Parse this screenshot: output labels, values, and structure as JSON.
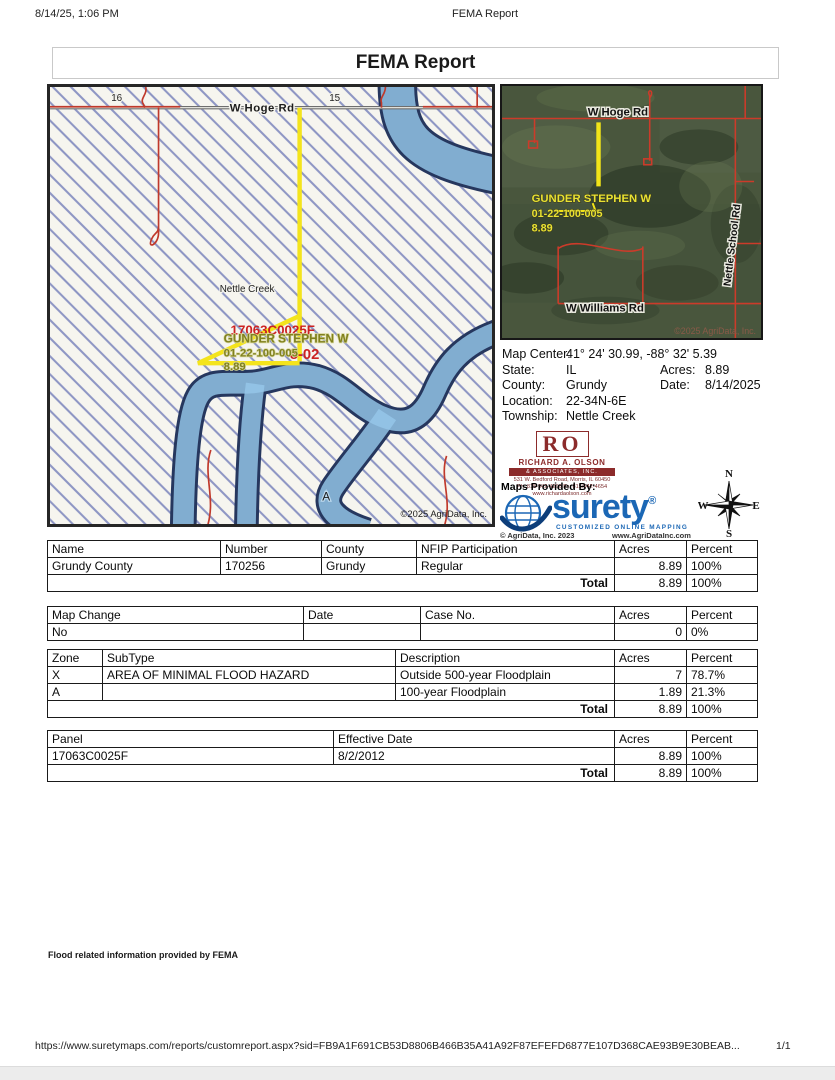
{
  "page": {
    "print_datetime": "8/14/25, 1:06 PM",
    "print_title": "FEMA Report",
    "title": "FEMA Report",
    "footer_note": "Flood related information provided by FEMA",
    "footer_url": "https://www.suretymaps.com/reports/customreport.aspx?sid=FB9A1F691CB53D8806B466B35A41A92F87EFEFD6877E107D368CAE93B9E30BEAB...",
    "footer_page": "1/1"
  },
  "flood_map": {
    "section_16": "16",
    "section_15": "15",
    "road_label": "W Hoge Rd",
    "creek_label": "Nettle Creek",
    "owner": "GUNDER STEPHEN W",
    "parcel_number": "01-22-100-005",
    "acres": "8.89",
    "overlay_panel": "17063C0025F",
    "overlay_suffix": "8-02",
    "zone_a_label": "A",
    "copyright": "©2025 AgriData, Inc."
  },
  "aerial_map": {
    "road_top": "W Hoge Rd",
    "road_bottom": "W Williams Rd",
    "road_right": "Nettle School Rd",
    "owner": "GUNDER STEPHEN W",
    "parcel_number": "01-22-100-005",
    "acres": "8.89",
    "copyright": "©2025 AgriData, Inc."
  },
  "map_info": {
    "map_center_label": "Map Center:",
    "map_center": "41° 24' 30.99, -88° 32' 5.39",
    "state_label": "State:",
    "state": "IL",
    "acres_label": "Acres:",
    "acres": "8.89",
    "county_label": "County:",
    "county": "Grundy",
    "date_label": "Date:",
    "date": "8/14/2025",
    "location_label": "Location:",
    "location": "22-34N-6E",
    "township_label": "Township:",
    "township": "Nettle Creek"
  },
  "branding": {
    "ro_initials": "RO",
    "ro_name": "Richard A. Olson",
    "ro_band": "& Associates, Inc.",
    "ro_address": "531 W. Bedford Road, Morris, IL 60450",
    "ro_phone": "Ph: 815-942-4266   Fx: 815/942-4654",
    "ro_web": "www.richardaolson.com",
    "maps_provided_by": "Maps Provided By:",
    "surety_name": "surety",
    "surety_reg": "®",
    "surety_tagline": "CUSTOMIZED ONLINE MAPPING",
    "agridata_copyright": "© AgriData, Inc. 2023",
    "agridata_web": "www.AgriDataInc.com"
  },
  "compass": {
    "n": "N",
    "e": "E",
    "s": "S",
    "w": "W"
  },
  "tables": [
    {
      "name": "NFIP participation",
      "headers": [
        "Name",
        "Number",
        "County",
        "NFIP Participation",
        "Acres",
        "Percent"
      ],
      "rows": [
        [
          "Grundy County",
          "170256",
          "Grundy",
          "Regular",
          "8.89",
          "100%"
        ]
      ],
      "total": {
        "label": "Total",
        "acres": "8.89",
        "percent": "100%"
      }
    },
    {
      "name": "Map change",
      "headers": [
        "Map Change",
        "Date",
        "Case No.",
        "Acres",
        "Percent"
      ],
      "rows": [
        [
          "No",
          "",
          "",
          "0",
          "0%"
        ]
      ]
    },
    {
      "name": "Flood zones",
      "headers": [
        "Zone",
        "SubType",
        "Description",
        "Acres",
        "Percent"
      ],
      "rows": [
        [
          "X",
          "AREA OF MINIMAL FLOOD HAZARD",
          "Outside 500-year Floodplain",
          "7",
          "78.7%"
        ],
        [
          "A",
          "",
          "100-year Floodplain",
          "1.89",
          "21.3%"
        ]
      ],
      "total": {
        "label": "Total",
        "acres": "8.89",
        "percent": "100%"
      }
    },
    {
      "name": "Panel",
      "headers": [
        "Panel",
        "Effective Date",
        "Acres",
        "Percent"
      ],
      "rows": [
        [
          "17063C0025F",
          "8/2/2012",
          "8.89",
          "100%"
        ]
      ],
      "total": {
        "label": "Total",
        "acres": "8.89",
        "percent": "100%"
      }
    }
  ],
  "colors": {
    "surety_blue": "#1b67b5",
    "ro_maroon": "#8c2b2b",
    "flood_yellow": "#f4e41c",
    "river_blue": "#96c7e9",
    "hatch_blue": "#8e96c4",
    "road_red": "#c0392b",
    "overlay_red": "#cc2222",
    "owner_label_olive": "#80801f"
  }
}
